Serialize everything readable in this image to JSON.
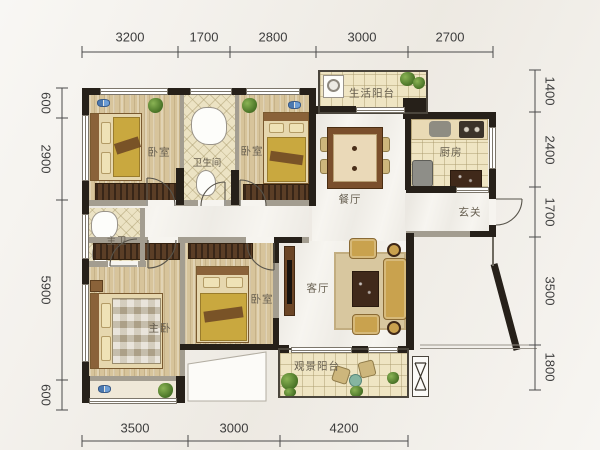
{
  "plan": {
    "type": "apartment-floor-plan"
  },
  "rooms": {
    "bedroom_top_left": {
      "label": "卧室"
    },
    "bathroom": {
      "label": "卫生间"
    },
    "bedroom_top_mid": {
      "label": "卧室"
    },
    "service_balcony": {
      "label": "生活阳台"
    },
    "kitchen": {
      "label": "厨房"
    },
    "dining": {
      "label": "餐厅"
    },
    "entry": {
      "label": "玄关"
    },
    "master_bath": {
      "label": "主卫"
    },
    "master_bedroom": {
      "label": "主卧"
    },
    "bedroom_bottom": {
      "label": "卧室"
    },
    "living": {
      "label": "客厅"
    },
    "view_balcony": {
      "label": "观景阳台"
    }
  },
  "dimensions": {
    "top": [
      "3200",
      "1700",
      "2800",
      "3000",
      "2700"
    ],
    "bottom": [
      "3500",
      "3000",
      "4200"
    ],
    "left": [
      "600",
      "2900",
      "5900",
      "600"
    ],
    "right": [
      "1400",
      "2400",
      "1700",
      "3500",
      "1800"
    ]
  },
  "colors": {
    "wall": "#262019",
    "wood_floor": "#d7c49b",
    "tile_floor": "#ece3c4",
    "marble_floor": "#f7f5f0",
    "bed_accent": "#c9a83f",
    "plant_green": "#4a7427",
    "dimension_text": "#3c3c3c"
  }
}
